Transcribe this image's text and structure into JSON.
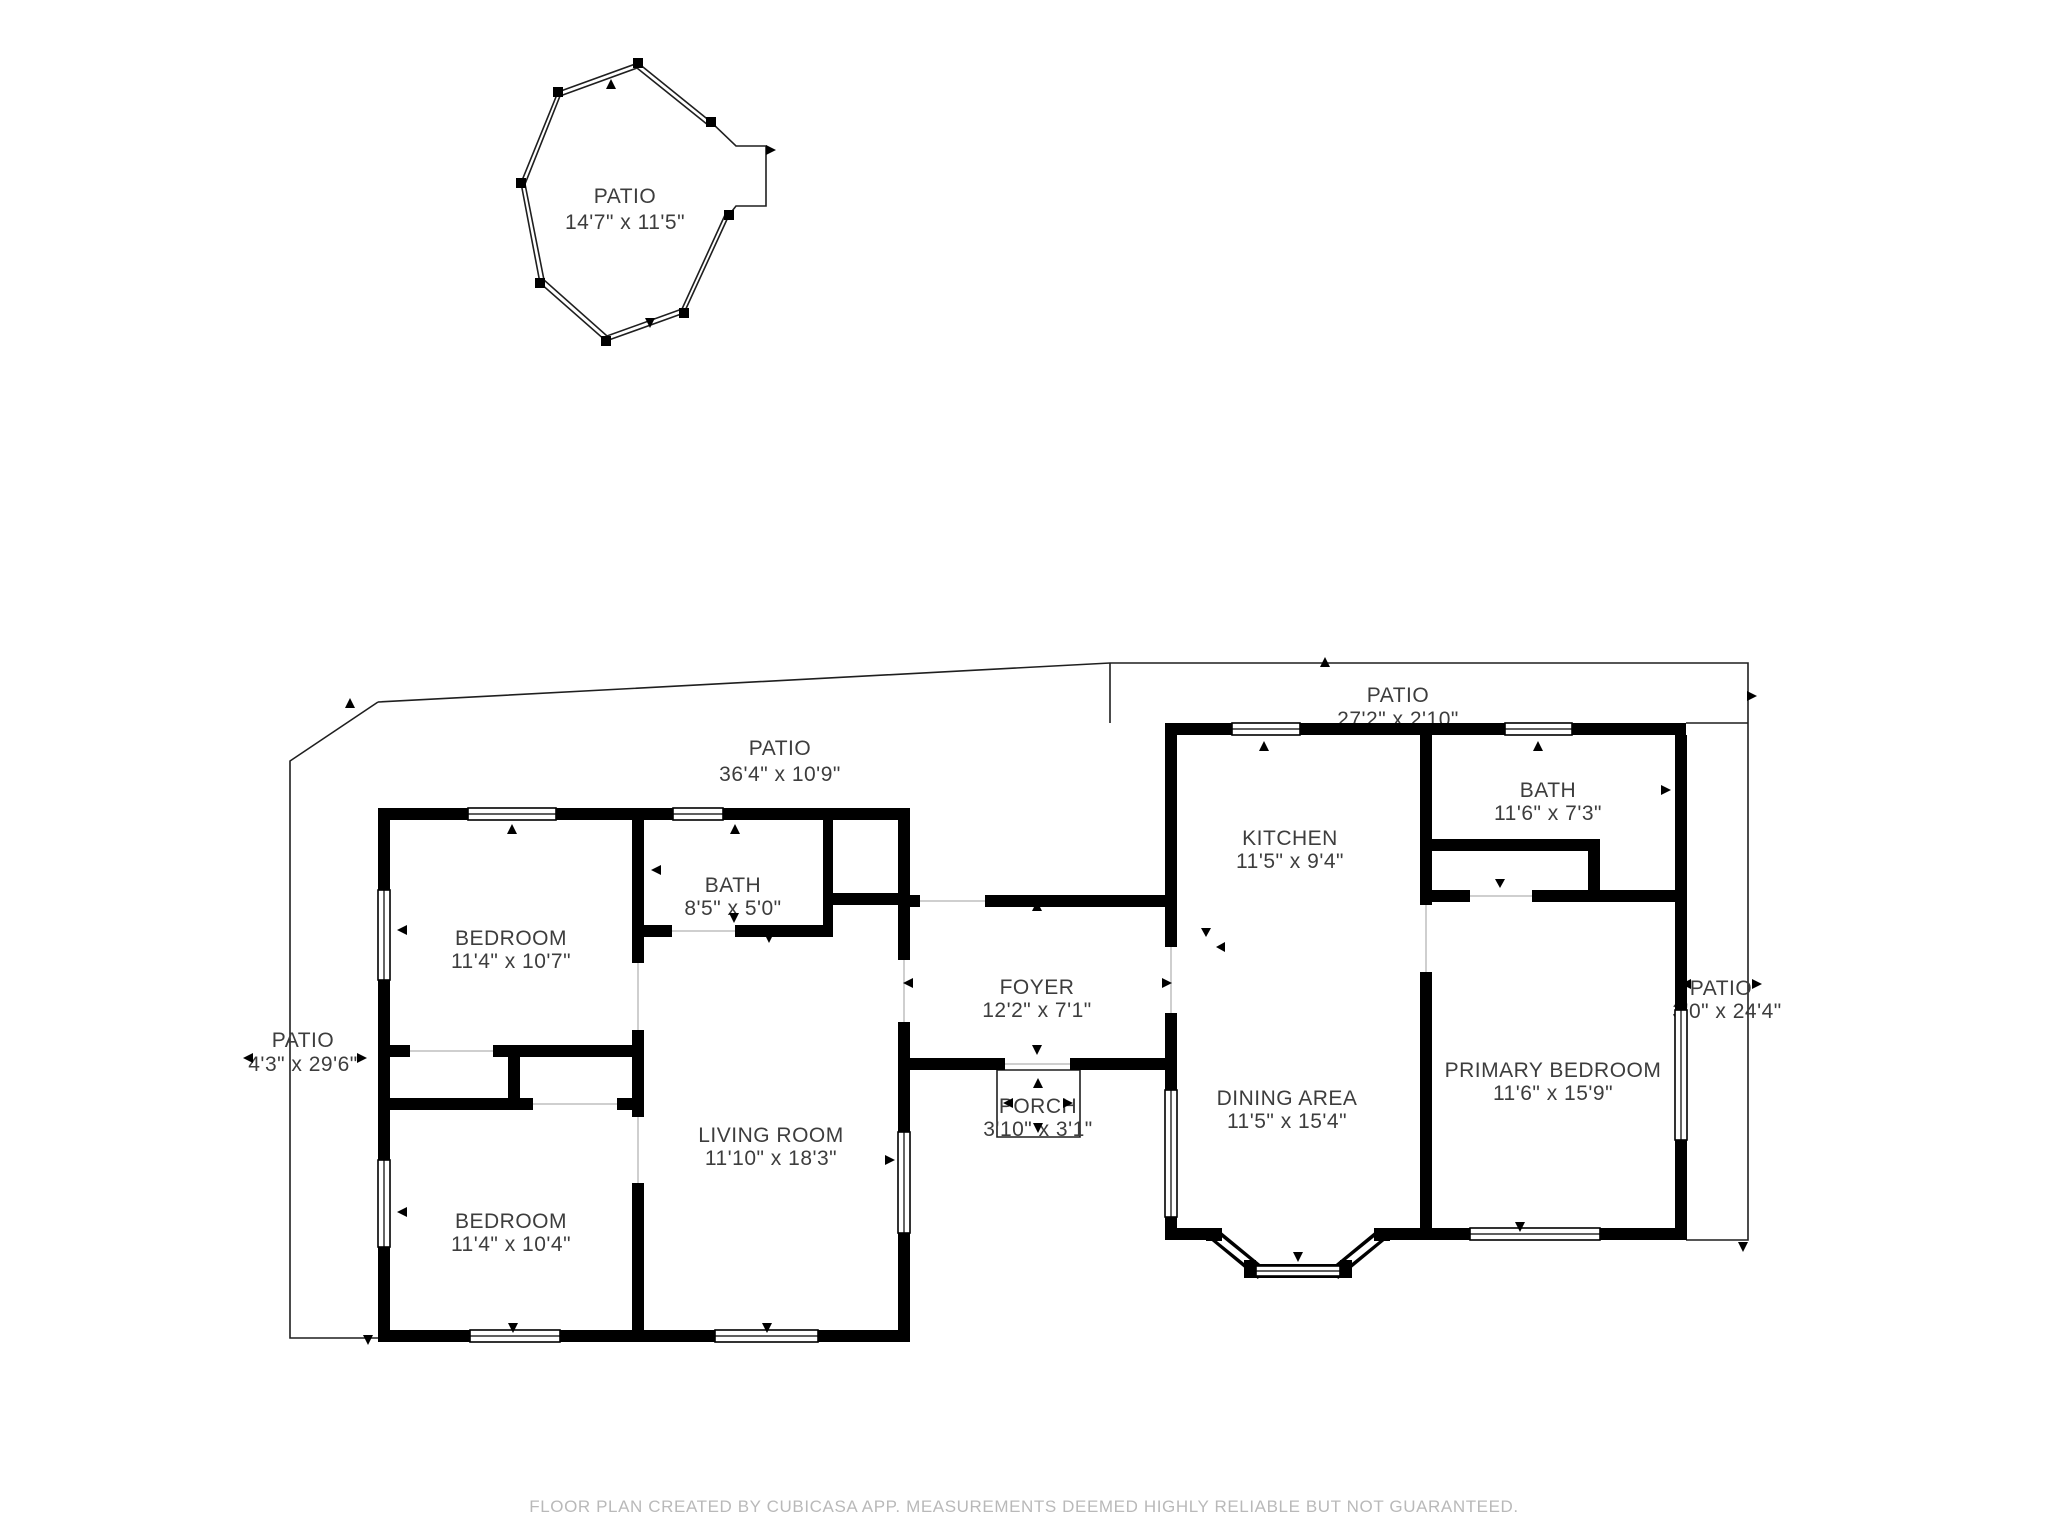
{
  "colors": {
    "wall": "#000000",
    "boundary_line": "#1f1f1f",
    "label_text": "#3d3d3d",
    "footer_text": "#b9b9b9",
    "background": "#ffffff"
  },
  "labels": [
    {
      "id": "patio-octagon",
      "name": "PATIO",
      "dims": "14'7\" x 11'5\""
    },
    {
      "id": "patio-top",
      "name": "PATIO",
      "dims": "36'4\" x 10'9\""
    },
    {
      "id": "patio-top-right",
      "name": "PATIO",
      "dims": "27'2\" x 2'10\""
    },
    {
      "id": "patio-right",
      "name": "PATIO",
      "dims": "3'0\" x 24'4\""
    },
    {
      "id": "patio-left",
      "name": "PATIO",
      "dims": "4'3\" x 29'6\""
    },
    {
      "id": "bedroom-1",
      "name": "BEDROOM",
      "dims": "11'4\" x 10'7\""
    },
    {
      "id": "bath-left",
      "name": "BATH",
      "dims": "8'5\" x 5'0\""
    },
    {
      "id": "bedroom-2",
      "name": "BEDROOM",
      "dims": "11'4\" x 10'4\""
    },
    {
      "id": "living-room",
      "name": "LIVING ROOM",
      "dims": "11'10\" x 18'3\""
    },
    {
      "id": "foyer",
      "name": "FOYER",
      "dims": "12'2\" x 7'1\""
    },
    {
      "id": "porch",
      "name": "PORCH",
      "dims": "3'10\" x 3'1\""
    },
    {
      "id": "kitchen",
      "name": "KITCHEN",
      "dims": "11'5\" x 9'4\""
    },
    {
      "id": "bath-right",
      "name": "BATH",
      "dims": "11'6\" x 7'3\""
    },
    {
      "id": "dining-area",
      "name": "DINING AREA",
      "dims": "11'5\" x 15'4\""
    },
    {
      "id": "primary-bedroom",
      "name": "PRIMARY BEDROOM",
      "dims": "11'6\" x 15'9\""
    }
  ],
  "footer": {
    "disclaimer": "FLOOR PLAN CREATED BY CUBICASA APP. MEASUREMENTS DEEMED HIGHLY RELIABLE BUT NOT GUARANTEED."
  }
}
